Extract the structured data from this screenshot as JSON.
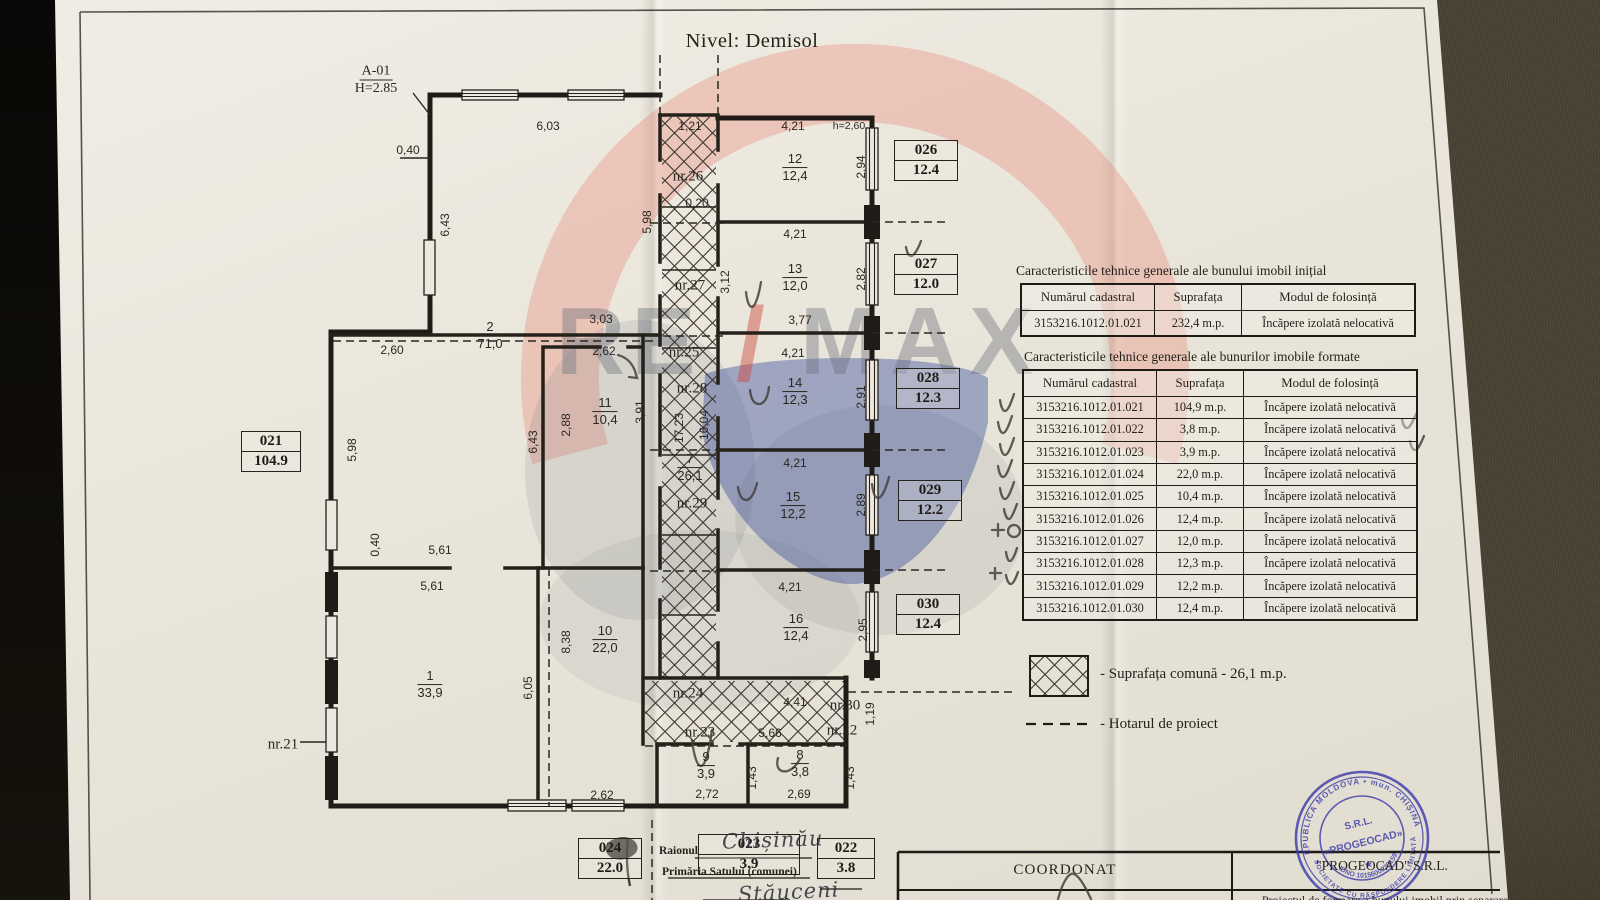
{
  "title": "Nivel: Demisol",
  "plan": {
    "section": "A-01",
    "height_label": "H=2.85",
    "dimensions": [
      {
        "t": "6,03",
        "x": 548,
        "y": 126
      },
      {
        "t": "1,21",
        "x": 690,
        "y": 126
      },
      {
        "t": "4,21",
        "x": 793,
        "y": 126
      },
      {
        "t": "h=2,60",
        "x": 849,
        "y": 126,
        "s": 10.5
      },
      {
        "t": "0,40",
        "x": 408,
        "y": 150
      },
      {
        "t": "0,20",
        "x": 697,
        "y": 203
      },
      {
        "t": "4,21",
        "x": 795,
        "y": 234
      },
      {
        "t": "3,03",
        "x": 601,
        "y": 319
      },
      {
        "t": "2,60",
        "x": 392,
        "y": 350
      },
      {
        "t": "2,62",
        "x": 604,
        "y": 351
      },
      {
        "t": "3,77",
        "x": 800,
        "y": 320
      },
      {
        "t": "4,21",
        "x": 793,
        "y": 353
      },
      {
        "t": "4,21",
        "x": 795,
        "y": 463
      },
      {
        "t": "4,21",
        "x": 790,
        "y": 587
      },
      {
        "t": "5,61",
        "x": 440,
        "y": 550
      },
      {
        "t": "5,61",
        "x": 432,
        "y": 586
      },
      {
        "t": "4,41",
        "x": 795,
        "y": 702
      },
      {
        "t": "5,66",
        "x": 770,
        "y": 733
      },
      {
        "t": "2,62",
        "x": 602,
        "y": 795
      },
      {
        "t": "2,72",
        "x": 707,
        "y": 794
      },
      {
        "t": "2,69",
        "x": 799,
        "y": 794
      },
      {
        "t": "2,94",
        "x": 861,
        "y": 167,
        "r": 1
      },
      {
        "t": "2,82",
        "x": 861,
        "y": 279,
        "r": 1
      },
      {
        "t": "2,91",
        "x": 861,
        "y": 397,
        "r": 1
      },
      {
        "t": "2,89",
        "x": 861,
        "y": 505,
        "r": 1
      },
      {
        "t": "2,95",
        "x": 863,
        "y": 630,
        "r": 1
      },
      {
        "t": "5,98",
        "x": 647,
        "y": 222,
        "r": 1
      },
      {
        "t": "6,43",
        "x": 445,
        "y": 225,
        "r": 1
      },
      {
        "t": "3,12",
        "x": 725,
        "y": 282,
        "r": 1
      },
      {
        "t": "2,88",
        "x": 566,
        "y": 425,
        "r": 1
      },
      {
        "t": "3,91",
        "x": 640,
        "y": 412,
        "r": 1
      },
      {
        "t": "17,23",
        "x": 679,
        "y": 428,
        "r": 1
      },
      {
        "t": "16,04",
        "x": 704,
        "y": 425,
        "r": 1
      },
      {
        "t": "6,43",
        "x": 533,
        "y": 442,
        "r": 1
      },
      {
        "t": "5,98",
        "x": 352,
        "y": 450,
        "r": 1
      },
      {
        "t": "0,40",
        "x": 375,
        "y": 545,
        "r": 1
      },
      {
        "t": "6,05",
        "x": 528,
        "y": 688,
        "r": 1
      },
      {
        "t": "8,38",
        "x": 566,
        "y": 642,
        "r": 1
      },
      {
        "t": "1,43",
        "x": 752,
        "y": 778,
        "r": 1
      },
      {
        "t": "1,43",
        "x": 850,
        "y": 778,
        "r": 1
      },
      {
        "t": "1,19",
        "x": 870,
        "y": 714,
        "r": 1
      }
    ],
    "room_numbers": [
      {
        "t": "nr.26",
        "x": 688,
        "y": 177
      },
      {
        "t": "nr.27",
        "x": 690,
        "y": 286
      },
      {
        "t": "nr.25",
        "x": 684,
        "y": 353
      },
      {
        "t": "nr.28",
        "x": 692,
        "y": 389
      },
      {
        "t": "nr.29",
        "x": 692,
        "y": 504
      },
      {
        "t": "nr.24",
        "x": 688,
        "y": 694
      },
      {
        "t": "nr.23",
        "x": 700,
        "y": 733
      },
      {
        "t": "nr.30",
        "x": 845,
        "y": 706
      },
      {
        "t": "nr.22",
        "x": 842,
        "y": 731
      },
      {
        "t": "nr.21",
        "x": 283,
        "y": 745
      }
    ],
    "rooms": [
      {
        "n": "2",
        "a": "71,0",
        "x": 490,
        "y": 336
      },
      {
        "n": "12",
        "a": "12,4",
        "x": 795,
        "y": 168
      },
      {
        "n": "13",
        "a": "12,0",
        "x": 795,
        "y": 278
      },
      {
        "n": "14",
        "a": "12,3",
        "x": 795,
        "y": 392
      },
      {
        "n": "15",
        "a": "12,2",
        "x": 793,
        "y": 506
      },
      {
        "n": "16",
        "a": "12,4",
        "x": 796,
        "y": 628
      },
      {
        "n": "11",
        "a": "10,4",
        "x": 605,
        "y": 412
      },
      {
        "n": "7",
        "a": "26,1",
        "x": 690,
        "y": 468
      },
      {
        "n": "1",
        "a": "33,9",
        "x": 430,
        "y": 685
      },
      {
        "n": "10",
        "a": "22,0",
        "x": 605,
        "y": 640
      },
      {
        "n": "9",
        "a": "3,9",
        "x": 706,
        "y": 766
      },
      {
        "n": "8",
        "a": "3,8",
        "x": 800,
        "y": 764
      }
    ],
    "id_boxes": [
      {
        "c": "021",
        "a": "104.9",
        "x": 241,
        "y": 431,
        "w": 58
      },
      {
        "c": "026",
        "a": "12.4",
        "x": 894,
        "y": 140
      },
      {
        "c": "027",
        "a": "12.0",
        "x": 894,
        "y": 254
      },
      {
        "c": "028",
        "a": "12.3",
        "x": 896,
        "y": 368
      },
      {
        "c": "029",
        "a": "12.2",
        "x": 898,
        "y": 480
      },
      {
        "c": "030",
        "a": "12.4",
        "x": 896,
        "y": 594
      },
      {
        "c": "024",
        "a": "22.0",
        "x": 578,
        "y": 838,
        "w": 62
      },
      {
        "c": "023",
        "a": "3.9",
        "x": 698,
        "y": 834,
        "w": 100
      },
      {
        "c": "022",
        "a": "3.8",
        "x": 817,
        "y": 838,
        "w": 56
      }
    ]
  },
  "tables": {
    "initial": {
      "title": "Caracteristicile tehnice generale ale bunului imobil inițial",
      "headers": [
        "Numărul cadastral",
        "Suprafața",
        "Modul de folosință"
      ],
      "rows": [
        [
          "3153216.1012.01.021",
          "232,4 m.p.",
          "Încăpere izolată nelocativă"
        ]
      ]
    },
    "formed": {
      "title": "Caracteristicile tehnice generale ale bunurilor imobile formate",
      "headers": [
        "Numărul cadastral",
        "Suprafața",
        "Modul de folosință"
      ],
      "rows": [
        [
          "3153216.1012.01.021",
          "104,9 m.p.",
          "Încăpere izolată nelocativă"
        ],
        [
          "3153216.1012.01.022",
          "3,8 m.p.",
          "Încăpere izolată nelocativă"
        ],
        [
          "3153216.1012.01.023",
          "3,9 m.p.",
          "Încăpere izolată nelocativă"
        ],
        [
          "3153216.1012.01.024",
          "22,0 m.p.",
          "Încăpere izolată nelocativă"
        ],
        [
          "3153216.1012.01.025",
          "10,4 m.p.",
          "Încăpere izolată nelocativă"
        ],
        [
          "3153216.1012.01.026",
          "12,4 m.p.",
          "Încăpere izolată nelocativă"
        ],
        [
          "3153216.1012.01.027",
          "12,0 m.p.",
          "Încăpere izolată nelocativă"
        ],
        [
          "3153216.1012.01.028",
          "12,3 m.p.",
          "Încăpere izolată nelocativă"
        ],
        [
          "3153216.1012.01.029",
          "12,2 m.p.",
          "Încăpere izolată nelocativă"
        ],
        [
          "3153216.1012.01.030",
          "12,4 m.p.",
          "Încăpere izolată nelocativă"
        ]
      ]
    }
  },
  "legend": {
    "common_area": "- Suprafața comună - 26,1 m.p.",
    "boundary": "- Hotarul de proiect"
  },
  "footer": {
    "raionul": "Raionul",
    "primaria": "Primăria Satului (comunei)",
    "handwriting_city": "Chișinău",
    "handwriting_village": "Stăuceni",
    "coordonat": "COORDONAT",
    "firm": "\"PROGEOCAD\" S.R.L.",
    "project": "Proiectul de formare a bunului imobil prin separare"
  },
  "stamp": {
    "ring_top": "REPUBLICA MOLDOVA • mun. CHIȘINĂU",
    "ring_bottom": "SOCIETATE CU RĂSPUNDERE LIMITATĂ",
    "idno": "IDNO 1015600020159",
    "srl": "S.R.L.",
    "name": "«PROGEOCAD»"
  },
  "watermark": {
    "re": "RE",
    "slash": "/",
    "max": "MAX"
  },
  "colors": {
    "paper": "#e9e5da",
    "ink": "#241f19",
    "stamp_blue": "#3d3daa",
    "watermark_pink": "#e88878",
    "watermark_blue": "#2f4698",
    "fabric": "#4a4233"
  }
}
